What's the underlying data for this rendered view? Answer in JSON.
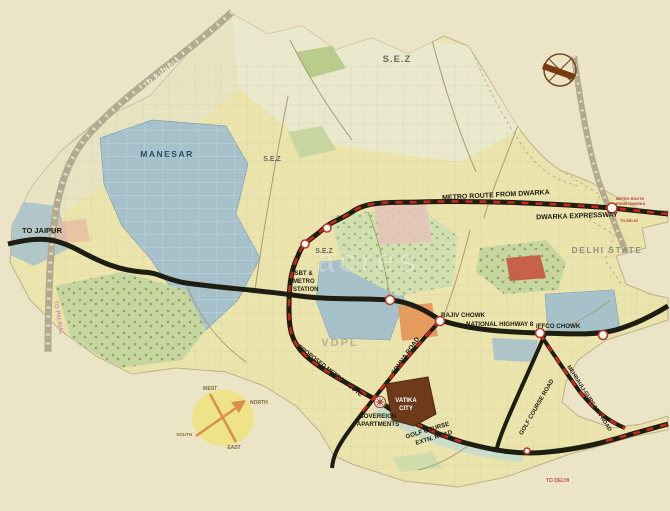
{
  "labels": {
    "to_jaipur": "TO JAIPUR",
    "to_kundli": "TO KUNDLI",
    "to_palwal": "TO PALWAL",
    "manesar": "MANESAR",
    "sez": "S.E.Z",
    "delhi_state": "DELHI STATE",
    "metro_route_from_dwarka": "METRO ROUTE FROM DWARKA",
    "dwarka_expressway": "DWARKA EXPRESSWAY",
    "metro_small_line1": "METRO ROUTE",
    "metro_small_line2": "FROM DWARKA",
    "to_delhi_small": "TO DELHI",
    "to_delhi_bottom": "TO DELHI",
    "isbt_line1": "ISBT &",
    "isbt_line2": "METRO",
    "isbt_line3": "STATION",
    "rajiv_chowk": "RAJIV CHOWK",
    "national_highway_8": "NATIONAL HIGHWAY 8",
    "iffco_chowk": "IFFCO CHOWK",
    "sohna_road": "SOHNA ROAD",
    "proposed_metro_route": "PROPOSED METRO ROUTE",
    "vatika_line1": "VATIKA",
    "vatika_line2": "CITY",
    "sovereign_line1": "SOVEREIGN",
    "sovereign_line2": "APARTMENTS",
    "gcx_line1": "GOLF COURSE",
    "gcx_line2": "EXTN. ROAD",
    "golf_course_road": "GOLF COURSE ROAD",
    "mg_road": "MEHRAULI-GURGAON ROAD",
    "watermark": "VDPL",
    "watermark_ghost": "acres",
    "compass": {
      "north": "NORTH",
      "south": "SOUTH",
      "east": "EAST",
      "west": "WEST"
    }
  },
  "colors": {
    "outer_background": "#ece4c6",
    "map_body": "#ece4ad",
    "road_black": "#1d1d12",
    "metro_red": "#c9281c",
    "zone_blue": "#a7c1cb",
    "zone_green": "#c7d6a0",
    "vatika_brown": "#6d3a1c",
    "orange_zone": "#e59a5e",
    "railway_gray": "#b3a98f"
  }
}
